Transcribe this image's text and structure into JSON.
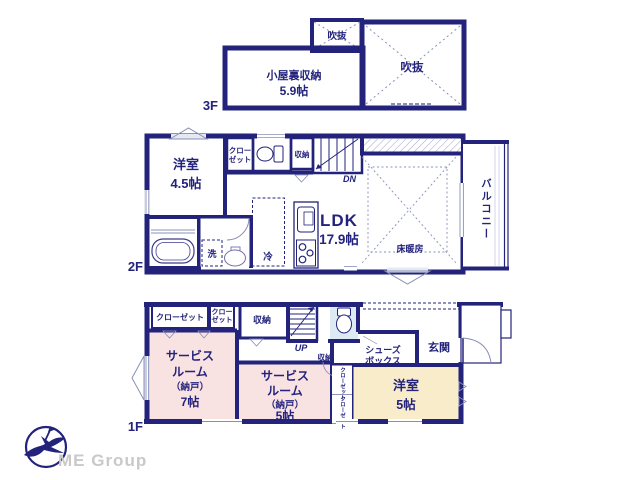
{
  "colors": {
    "wall": "#23237b",
    "text": "#23237d",
    "room_pink": "#f9e2e2",
    "room_cream": "#f8ecca",
    "room_blue": "#dde9f3",
    "logo_gray": "#c9c9c9"
  },
  "floor3": {
    "label": "3F",
    "attic_name": "小屋裏収納",
    "attic_size": "5.9帖",
    "void_small": "吹抜",
    "void_large": "吹抜"
  },
  "floor2": {
    "label": "2F",
    "western_name": "洋室",
    "western_size": "4.5帖",
    "closet_l1": "クロー",
    "closet_l2": "ゼット",
    "storage": "収納",
    "stairs": "DN",
    "ldk_name": "LDK",
    "ldk_size": "17.9帖",
    "floor_heating": "床暖房",
    "balcony": "バルコニー",
    "washer": "洗",
    "fridge": "冷"
  },
  "floor1": {
    "label": "1F",
    "closet_wide": "クローゼット",
    "closet_small_l1": "クロー",
    "closet_small_l2": "ゼット",
    "storage_top": "収納",
    "stairs": "UP",
    "storage_under_stairs": "収納",
    "service7_l1": "サービス",
    "service7_l2": "ルーム",
    "service7_l3": "（納戸）",
    "service7_l4": "7帖",
    "service5_l1": "サービス",
    "service5_l2": "ルーム",
    "service5_l3": "（納戸）",
    "service5_l4": "5帖",
    "shoes_l1": "シューズ",
    "shoes_l2": "ボックス",
    "entrance": "玄関",
    "western_name": "洋室",
    "western_size": "5帖",
    "closet_v1": "クローゼット",
    "closet_v2": "クローゼット"
  },
  "logo": {
    "text": "ME Group"
  }
}
